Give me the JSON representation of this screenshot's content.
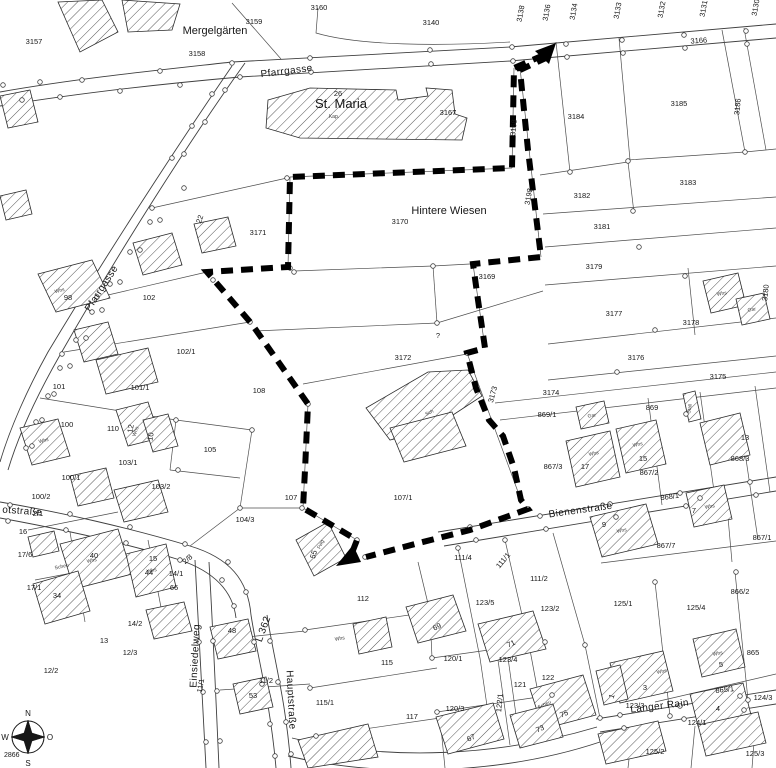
{
  "map": {
    "type": "cadastral-plan",
    "place_labels": [
      {
        "t": "Mergelgärten",
        "x": 215,
        "y": 34
      },
      {
        "t": "Hintere Wiesen",
        "x": 449,
        "y": 214
      }
    ],
    "stmaria_label": {
      "t": "St. Maria",
      "x": 341,
      "y": 108
    },
    "chapel_label": {
      "t": "Kap.",
      "x": 334,
      "y": 118
    },
    "street_labels": [
      {
        "t": "Pfarrgasse",
        "x": 287,
        "y": 74,
        "r": -7
      },
      {
        "t": "Pfarrgasse",
        "x": 104,
        "y": 290,
        "r": -57
      },
      {
        "t": "otstraße",
        "x": 22,
        "y": 514,
        "r": 4
      },
      {
        "t": "Bienenstraße",
        "x": 581,
        "y": 513,
        "r": -8
      },
      {
        "t": "Hauptstraße",
        "x": 288,
        "y": 700,
        "r": 87
      },
      {
        "t": "Einsiedelweg",
        "x": 198,
        "y": 656,
        "r": -87
      },
      {
        "t": "Langer Rain",
        "x": 660,
        "y": 709,
        "r": -7
      },
      {
        "t": "L 362",
        "x": 266,
        "y": 630,
        "r": -70,
        "s": 8.5
      }
    ],
    "parcel_labels": [
      {
        "t": "3157",
        "x": 34,
        "y": 44
      },
      {
        "t": "3158",
        "x": 197,
        "y": 56
      },
      {
        "t": "3159",
        "x": 254,
        "y": 24
      },
      {
        "t": "3160",
        "x": 319,
        "y": 10
      },
      {
        "t": "3140",
        "x": 431,
        "y": 25
      },
      {
        "t": "3138",
        "x": 523,
        "y": 14,
        "r": -80
      },
      {
        "t": "3136",
        "x": 549,
        "y": 13,
        "r": -80
      },
      {
        "t": "3134",
        "x": 576,
        "y": 12,
        "r": -80
      },
      {
        "t": "3133",
        "x": 620,
        "y": 11,
        "r": -80
      },
      {
        "t": "3132",
        "x": 664,
        "y": 10,
        "r": -80
      },
      {
        "t": "3131",
        "x": 706,
        "y": 9,
        "r": -80
      },
      {
        "t": "3130",
        "x": 758,
        "y": 8,
        "r": -80
      },
      {
        "t": "3166",
        "x": 699,
        "y": 43,
        "r": -4
      },
      {
        "t": "3167",
        "x": 448,
        "y": 115
      },
      {
        "t": "3168",
        "x": 516,
        "y": 128,
        "r": -84
      },
      {
        "t": "3184",
        "x": 576,
        "y": 119
      },
      {
        "t": "3185",
        "x": 679,
        "y": 106
      },
      {
        "t": "3186",
        "x": 740,
        "y": 107,
        "r": -84
      },
      {
        "t": "3183",
        "x": 688,
        "y": 185
      },
      {
        "t": "3182",
        "x": 582,
        "y": 198
      },
      {
        "t": "3181",
        "x": 602,
        "y": 229
      },
      {
        "t": "3198",
        "x": 531,
        "y": 197,
        "r": -80
      },
      {
        "t": "3179",
        "x": 594,
        "y": 269
      },
      {
        "t": "3169",
        "x": 487,
        "y": 279
      },
      {
        "t": "3171",
        "x": 258,
        "y": 235
      },
      {
        "t": "3170",
        "x": 400,
        "y": 224
      },
      {
        "t": "3177",
        "x": 614,
        "y": 316
      },
      {
        "t": "3178",
        "x": 691,
        "y": 325
      },
      {
        "t": "3180",
        "x": 768,
        "y": 293,
        "r": -84
      },
      {
        "t": "3176",
        "x": 636,
        "y": 360
      },
      {
        "t": "3175",
        "x": 718,
        "y": 379
      },
      {
        "t": "3172",
        "x": 403,
        "y": 360
      },
      {
        "t": "?",
        "x": 438,
        "y": 338,
        "s": 12
      },
      {
        "t": "3174",
        "x": 551,
        "y": 395
      },
      {
        "t": "3173",
        "x": 495,
        "y": 395,
        "r": -75
      },
      {
        "t": "869/1",
        "x": 547,
        "y": 417
      },
      {
        "t": "869",
        "x": 652,
        "y": 410
      },
      {
        "t": "868/3",
        "x": 740,
        "y": 461
      },
      {
        "t": "868/1",
        "x": 670,
        "y": 499,
        "r": -8
      },
      {
        "t": "867/3",
        "x": 553,
        "y": 469
      },
      {
        "t": "867/2",
        "x": 649,
        "y": 475
      },
      {
        "t": "867/7",
        "x": 666,
        "y": 548
      },
      {
        "t": "867/1",
        "x": 762,
        "y": 540
      },
      {
        "t": "866/2",
        "x": 740,
        "y": 594
      },
      {
        "t": "865",
        "x": 753,
        "y": 655
      },
      {
        "t": "865/1",
        "x": 725,
        "y": 692,
        "r": -6
      },
      {
        "t": "102",
        "x": 149,
        "y": 300
      },
      {
        "t": "98",
        "x": 68,
        "y": 300
      },
      {
        "t": "102/1",
        "x": 186,
        "y": 354
      },
      {
        "t": "101",
        "x": 59,
        "y": 389
      },
      {
        "t": "101/1",
        "x": 140,
        "y": 390
      },
      {
        "t": "100",
        "x": 67,
        "y": 427
      },
      {
        "t": "110",
        "x": 113,
        "y": 431
      },
      {
        "t": "105",
        "x": 210,
        "y": 452
      },
      {
        "t": "103/1",
        "x": 128,
        "y": 465
      },
      {
        "t": "103/2",
        "x": 161,
        "y": 489
      },
      {
        "t": "100/1",
        "x": 71,
        "y": 480
      },
      {
        "t": "100/2",
        "x": 41,
        "y": 499
      },
      {
        "t": "104/3",
        "x": 245,
        "y": 522
      },
      {
        "t": "107",
        "x": 291,
        "y": 500
      },
      {
        "t": "107/1",
        "x": 403,
        "y": 500
      },
      {
        "t": "108",
        "x": 259,
        "y": 393
      },
      {
        "t": "2/1",
        "x": 38,
        "y": 516
      },
      {
        "t": "16",
        "x": 23,
        "y": 534
      },
      {
        "t": "17/6",
        "x": 25,
        "y": 557
      },
      {
        "t": "17/1",
        "x": 34,
        "y": 590
      },
      {
        "t": "14/1",
        "x": 176,
        "y": 576
      },
      {
        "t": "2/8",
        "x": 189,
        "y": 561,
        "r": -40,
        "s": 7
      },
      {
        "t": "14/2",
        "x": 135,
        "y": 626
      },
      {
        "t": "13",
        "x": 104,
        "y": 643
      },
      {
        "t": "12/3",
        "x": 130,
        "y": 655
      },
      {
        "t": "12/2",
        "x": 51,
        "y": 673
      },
      {
        "t": "11/2",
        "x": 266,
        "y": 683
      },
      {
        "t": "11/1",
        "x": 203,
        "y": 686,
        "r": -80
      },
      {
        "t": "112",
        "x": 363,
        "y": 601
      },
      {
        "t": "111/4",
        "x": 463,
        "y": 560
      },
      {
        "t": "111/1",
        "x": 505,
        "y": 562,
        "r": -50,
        "s": 7
      },
      {
        "t": "111/2",
        "x": 539,
        "y": 581
      },
      {
        "t": "115",
        "x": 387,
        "y": 665
      },
      {
        "t": "115/1",
        "x": 325,
        "y": 705
      },
      {
        "t": "117",
        "x": 412,
        "y": 719
      },
      {
        "t": "123/5",
        "x": 485,
        "y": 605
      },
      {
        "t": "123/2",
        "x": 550,
        "y": 611
      },
      {
        "t": "123/4",
        "x": 508,
        "y": 662
      },
      {
        "t": "123/3",
        "x": 635,
        "y": 708,
        "s": 7
      },
      {
        "t": "122",
        "x": 548,
        "y": 680
      },
      {
        "t": "121",
        "x": 520,
        "y": 687
      },
      {
        "t": "120/1",
        "x": 453,
        "y": 661
      },
      {
        "t": "120/3",
        "x": 455,
        "y": 711
      },
      {
        "t": "122/1",
        "x": 502,
        "y": 703,
        "r": -85,
        "s": 7
      },
      {
        "t": "125/1",
        "x": 623,
        "y": 606
      },
      {
        "t": "125/4",
        "x": 696,
        "y": 610
      },
      {
        "t": "125/2",
        "x": 655,
        "y": 754
      },
      {
        "t": "125/3",
        "x": 755,
        "y": 756
      },
      {
        "t": "124/1",
        "x": 697,
        "y": 725
      },
      {
        "t": "124/3",
        "x": 763,
        "y": 700
      }
    ],
    "house_numbers": [
      {
        "t": "26",
        "x": 338,
        "y": 96
      },
      {
        "t": "22",
        "x": 202,
        "y": 220,
        "r": -70
      },
      {
        "t": "12",
        "x": 133,
        "y": 429,
        "r": -80
      },
      {
        "t": "10",
        "x": 153,
        "y": 437,
        "r": -80
      },
      {
        "t": "34",
        "x": 57,
        "y": 598
      },
      {
        "t": "44",
        "x": 149,
        "y": 575
      },
      {
        "t": "40",
        "x": 94,
        "y": 558
      },
      {
        "t": "15",
        "x": 153,
        "y": 561,
        "s": 7
      },
      {
        "t": "66",
        "x": 174,
        "y": 590,
        "s": 6
      },
      {
        "t": "53",
        "x": 253,
        "y": 698,
        "s": 7
      },
      {
        "t": "48",
        "x": 232,
        "y": 633
      },
      {
        "t": "55",
        "x": 316,
        "y": 555,
        "r": -75
      },
      {
        "t": "17",
        "x": 585,
        "y": 469
      },
      {
        "t": "15",
        "x": 643,
        "y": 461
      },
      {
        "t": "13",
        "x": 745,
        "y": 440
      },
      {
        "t": "9",
        "x": 604,
        "y": 527
      },
      {
        "t": "7",
        "x": 694,
        "y": 513
      },
      {
        "t": "5",
        "x": 721,
        "y": 667
      },
      {
        "t": "3",
        "x": 645,
        "y": 690
      },
      {
        "t": "4",
        "x": 718,
        "y": 711
      },
      {
        "t": "1",
        "x": 614,
        "y": 697,
        "r": -70
      },
      {
        "t": "69",
        "x": 438,
        "y": 629,
        "r": -25,
        "s": 7
      },
      {
        "t": "71",
        "x": 512,
        "y": 646,
        "r": -25,
        "s": 7
      },
      {
        "t": "75",
        "x": 565,
        "y": 716,
        "r": -25,
        "s": 7
      },
      {
        "t": "73",
        "x": 541,
        "y": 731,
        "r": -25,
        "s": 7
      },
      {
        "t": "67",
        "x": 472,
        "y": 740,
        "r": -25
      }
    ],
    "building_labels": [
      {
        "t": "Whs",
        "x": 60,
        "y": 292,
        "r": -15
      },
      {
        "t": "Whs",
        "x": 44,
        "y": 442,
        "r": -15
      },
      {
        "t": "Whs",
        "x": 137,
        "y": 432,
        "r": -70
      },
      {
        "t": "Sch",
        "x": 430,
        "y": 414,
        "r": -25
      },
      {
        "t": "Fwg",
        "x": 322,
        "y": 545,
        "r": -65
      },
      {
        "t": "Whs",
        "x": 594,
        "y": 455,
        "r": -12
      },
      {
        "t": "Whs",
        "x": 638,
        "y": 446,
        "r": -12
      },
      {
        "t": "Gar",
        "x": 592,
        "y": 417,
        "r": -10
      },
      {
        "t": "Whs",
        "x": 722,
        "y": 295,
        "r": -10
      },
      {
        "t": "Gar",
        "x": 752,
        "y": 311,
        "r": -10
      },
      {
        "t": "Whs",
        "x": 622,
        "y": 532,
        "r": -12
      },
      {
        "t": "Whs",
        "x": 710,
        "y": 508,
        "r": -10
      },
      {
        "t": "Stall",
        "x": 691,
        "y": 409,
        "r": -80
      },
      {
        "t": "Scheu",
        "x": 62,
        "y": 568,
        "r": -12
      },
      {
        "t": "Whs",
        "x": 92,
        "y": 562,
        "r": -12
      },
      {
        "t": "Whs",
        "x": 152,
        "y": 572,
        "r": -12
      },
      {
        "t": "Whs",
        "x": 662,
        "y": 673,
        "r": -12
      },
      {
        "t": "Scheu",
        "x": 545,
        "y": 706,
        "r": -25
      },
      {
        "t": "Whs",
        "x": 718,
        "y": 655,
        "r": -12
      },
      {
        "t": "Whs",
        "x": 340,
        "y": 640,
        "r": -10
      }
    ],
    "compass": {
      "north": "N",
      "east": "O",
      "south": "S",
      "west": "W",
      "sheet_number": "2866"
    },
    "boundary": {
      "color": "#000000",
      "west_line": [
        [
          544,
          55
        ],
        [
          514,
          68
        ],
        [
          512,
          168
        ],
        [
          290,
          177
        ],
        [
          288,
          267
        ],
        [
          207,
          272
        ],
        [
          251,
          323
        ],
        [
          308,
          404
        ],
        [
          305,
          470
        ],
        [
          303,
          508
        ],
        [
          357,
          540
        ],
        [
          350,
          558
        ]
      ],
      "east_line": [
        [
          548,
          57
        ],
        [
          520,
          70
        ],
        [
          528,
          150
        ],
        [
          541,
          257
        ],
        [
          473,
          264
        ],
        [
          478,
          300
        ],
        [
          485,
          348
        ],
        [
          467,
          353
        ],
        [
          476,
          388
        ],
        [
          489,
          420
        ],
        [
          503,
          436
        ],
        [
          514,
          468
        ],
        [
          521,
          500
        ],
        [
          528,
          509
        ],
        [
          470,
          530
        ],
        [
          415,
          544
        ],
        [
          366,
          557
        ]
      ],
      "arrow_north": [
        [
          556,
          43
        ],
        [
          535,
          51
        ],
        [
          549,
          64
        ]
      ],
      "arrow_south": [
        [
          336,
          566
        ],
        [
          353,
          545
        ],
        [
          361,
          562
        ]
      ]
    }
  }
}
